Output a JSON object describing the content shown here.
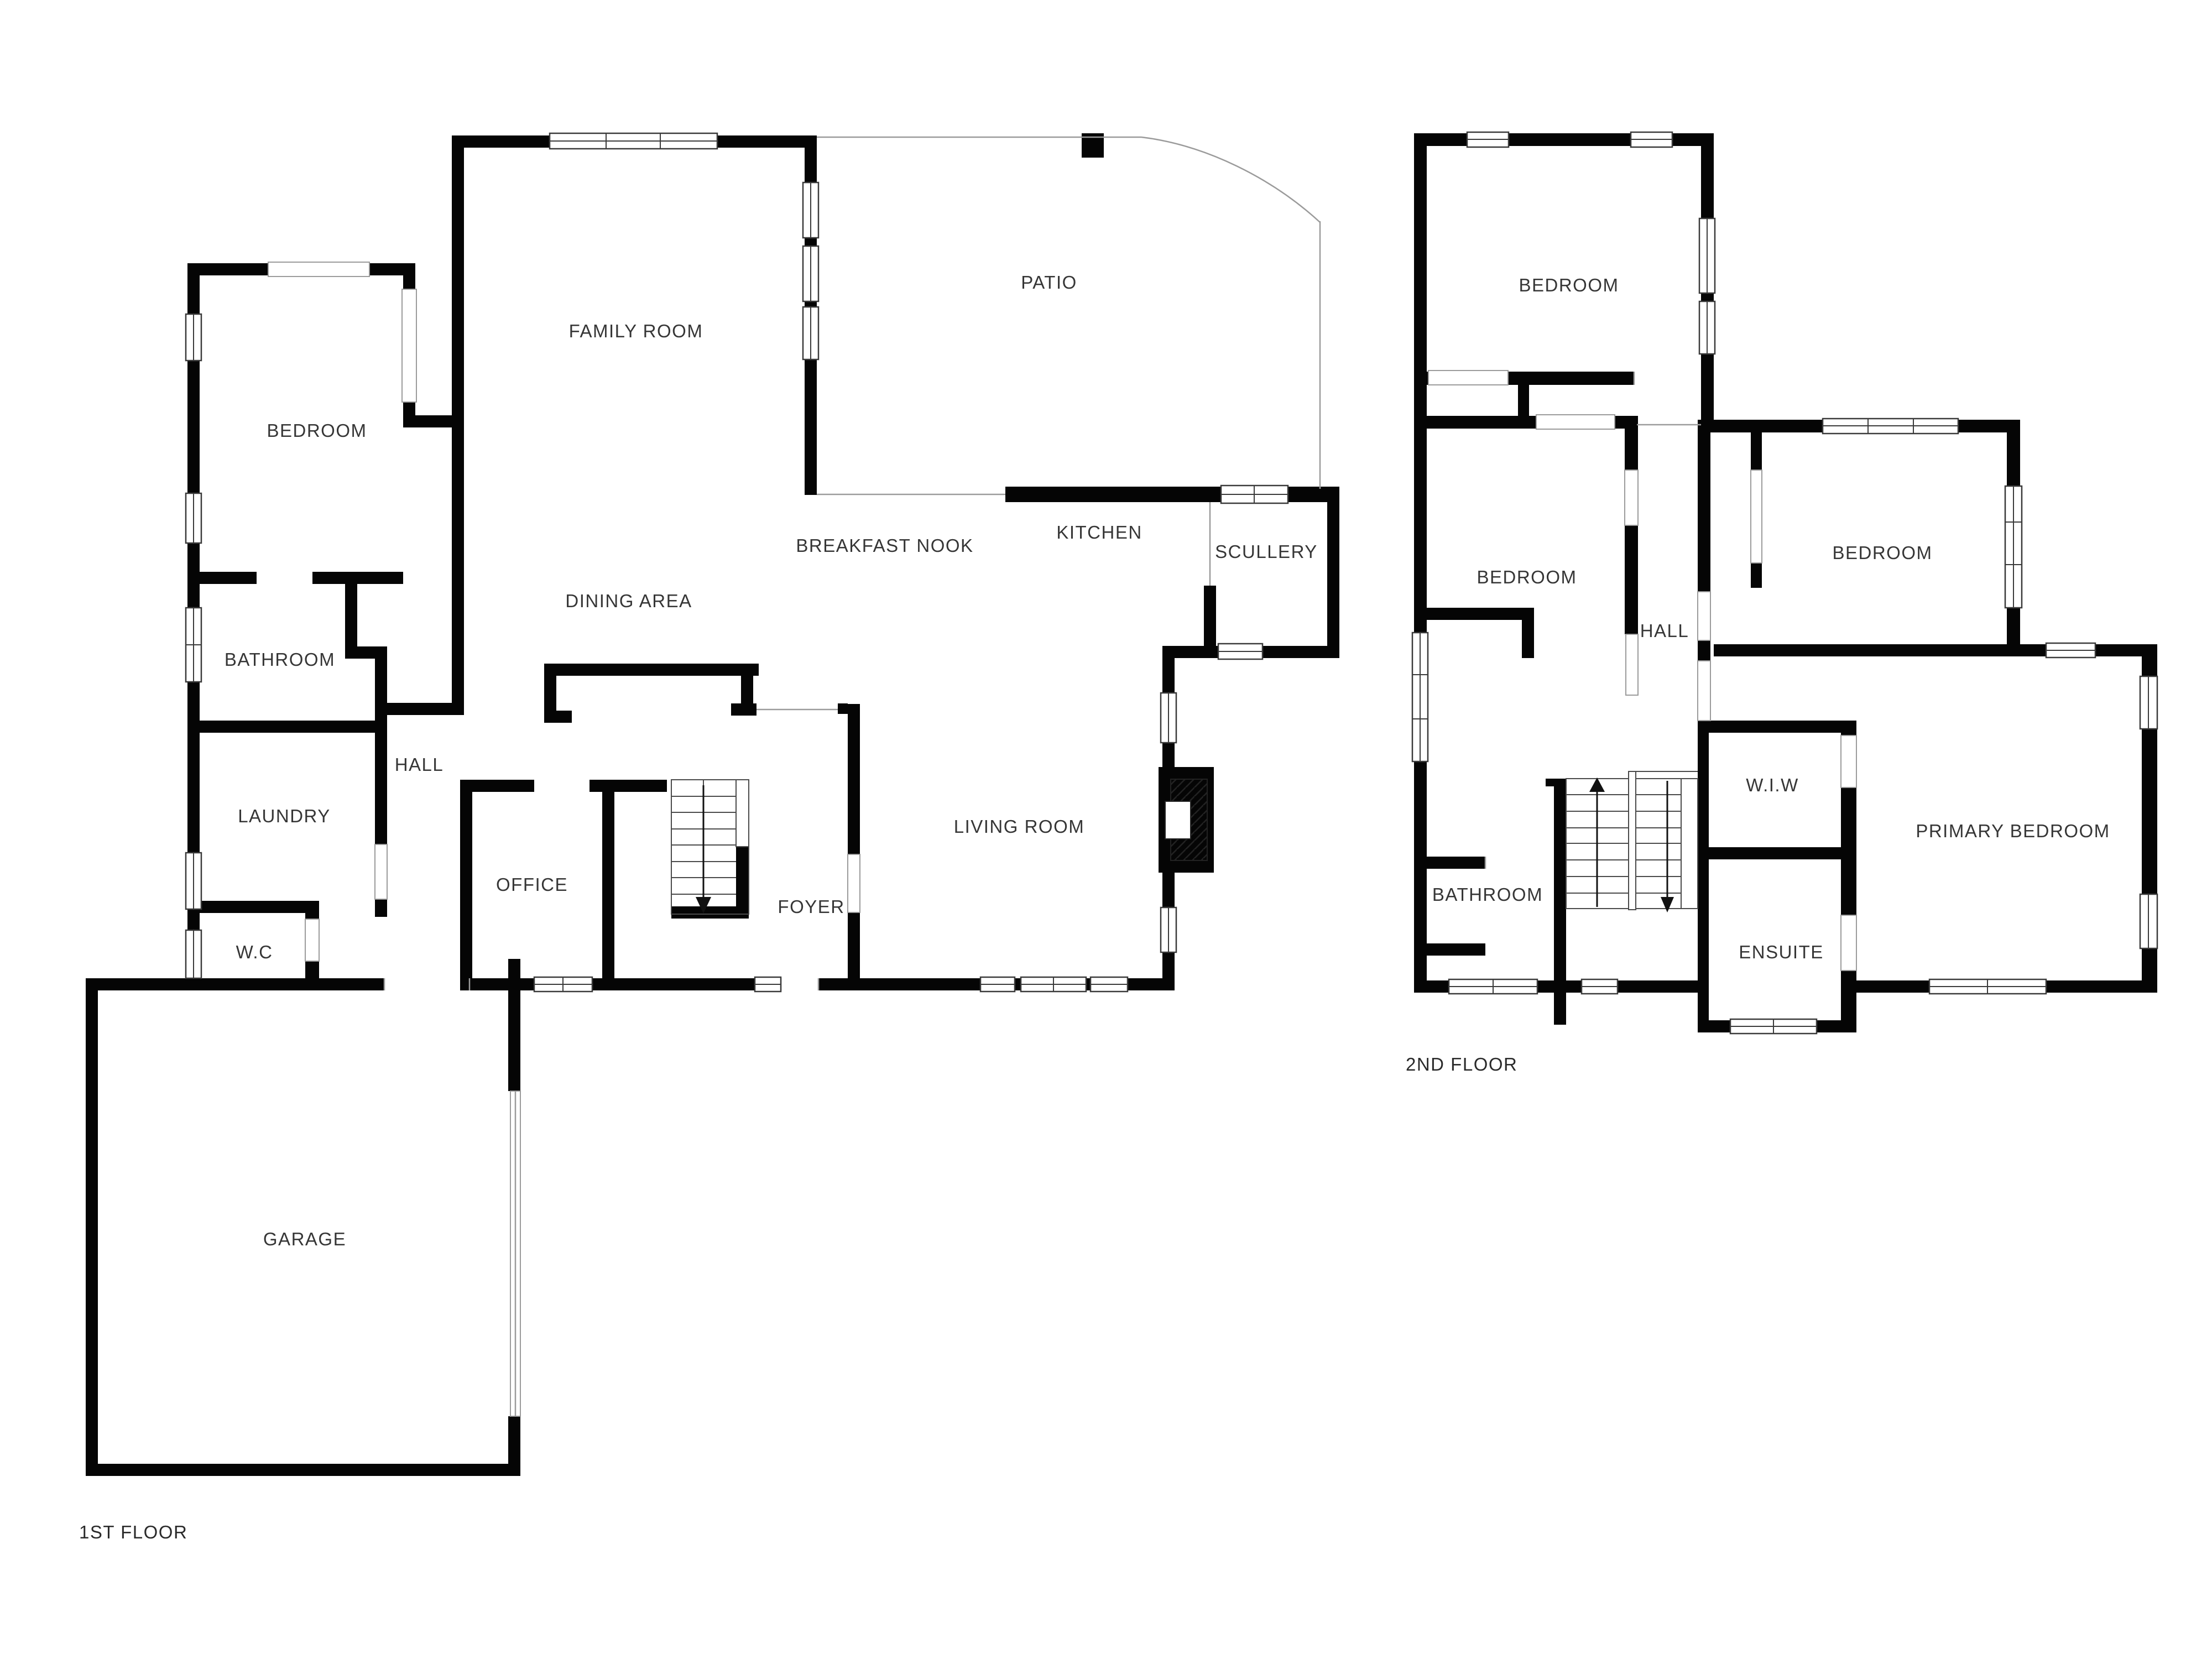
{
  "document": {
    "type": "floor-plan",
    "background_color": "#ffffff",
    "wall_color": "#050505",
    "label_color": "#363636"
  },
  "floor1": {
    "title": "1ST FLOOR",
    "rooms": [
      {
        "label": "FAMILY ROOM"
      },
      {
        "label": "PATIO"
      },
      {
        "label": "BEDROOM"
      },
      {
        "label": "BREAKFAST NOOK"
      },
      {
        "label": "KITCHEN"
      },
      {
        "label": "SCULLERY"
      },
      {
        "label": "DINING AREA"
      },
      {
        "label": "BATHROOM"
      },
      {
        "label": "HALL"
      },
      {
        "label": "LAUNDRY"
      },
      {
        "label": "LIVING ROOM"
      },
      {
        "label": "OFFICE"
      },
      {
        "label": "FOYER"
      },
      {
        "label": "W.C"
      },
      {
        "label": "GARAGE"
      }
    ]
  },
  "floor2": {
    "title": "2ND FLOOR",
    "rooms": [
      {
        "label": "BEDROOM"
      },
      {
        "label": "BEDROOM"
      },
      {
        "label": "HALL"
      },
      {
        "label": "BEDROOM"
      },
      {
        "label": "BATHROOM"
      },
      {
        "label": "W.I.W"
      },
      {
        "label": "ENSUITE"
      },
      {
        "label": "PRIMARY BEDROOM"
      }
    ]
  }
}
